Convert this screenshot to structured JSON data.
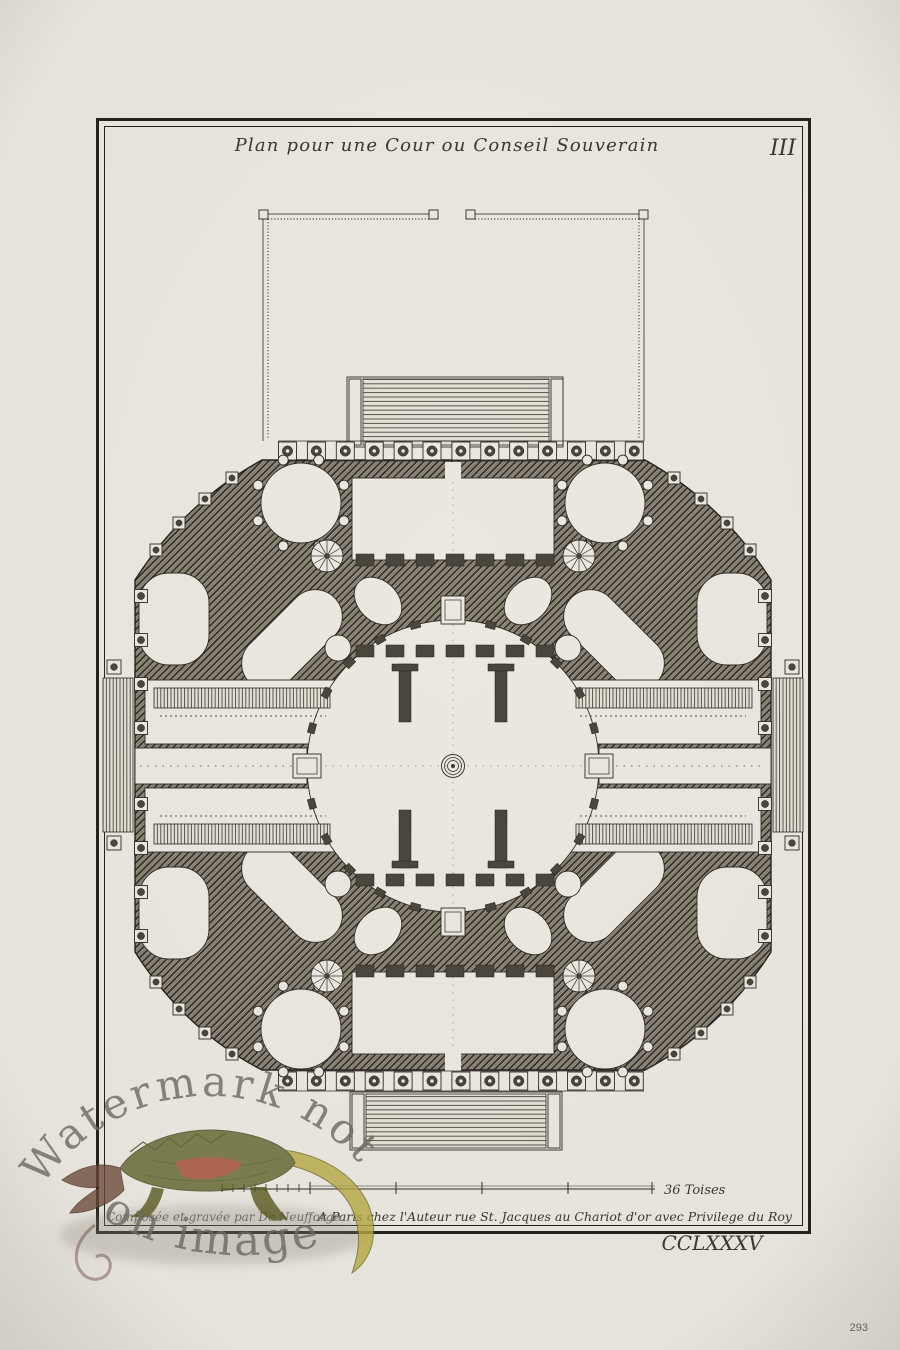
{
  "plate": {
    "title": "Plan pour une Cour ou Conseil Souverain",
    "plate_number_top": "III",
    "plate_number_bottom": "CCLXXXV",
    "page_number": "293",
    "scale_label": "36 Toises",
    "credit_left": "Composée et gravée par De Neufforge",
    "credit_right": "A Paris chez l'Auteur rue St. Jacques au Chariot d'or avec Privilege du Roy"
  },
  "watermark": {
    "line1": "Watermark not",
    "line2": "on image",
    "icon": "crocodile-watermark"
  },
  "colors": {
    "paper": "#ebe8e1",
    "ink": "#2e2a25",
    "poche_dark": "#4a453d",
    "watermark_text": "#6e6960",
    "croc_green": "#5c5e27",
    "croc_yellow": "#b3a63c",
    "croc_red": "#a5402a"
  }
}
